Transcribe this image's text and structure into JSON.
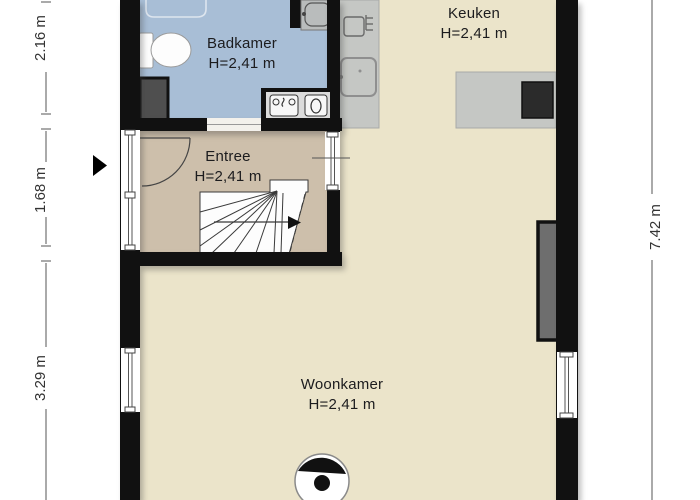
{
  "rooms": {
    "badkamer": {
      "name": "Badkamer",
      "height": "H=2,41 m"
    },
    "keuken": {
      "name": "Keuken",
      "height": "H=2,41 m"
    },
    "entree": {
      "name": "Entree",
      "height": "H=2,41 m"
    },
    "woonkamer": {
      "name": "Woonkamer",
      "height": "H=2,41 m"
    }
  },
  "dimensions": {
    "left": [
      {
        "label": "2.16 m"
      },
      {
        "label": "1.68 m"
      },
      {
        "label": "3.29 m"
      }
    ],
    "right": [
      {
        "label": "7.42 m"
      }
    ]
  },
  "icons": {
    "entrance": "entrance-arrow-icon",
    "stairs": "stairs-icon",
    "door": "door-swing-icon",
    "toilet": "toilet-icon",
    "shower": "shower-icon",
    "corner_washbasin": "washbasin-icon",
    "vanity": "double-washbasin-icon",
    "kitchen_sink": "kitchen-sink-icon",
    "cooktop": "cooktop-icon",
    "oven": "dark-appliance-icon",
    "stove": "wood-stove-icon",
    "radiator": "radiator-icon",
    "window": "window-icon"
  },
  "colors": {
    "outside": "#ffffff",
    "wall": "#111111",
    "bathroom_floor": "#a8bed6",
    "entree_floor": "#cdbfab",
    "living_floor": "#ebe4ca",
    "counter": "#c5c7c4",
    "counter_border": "#a8aaa8",
    "appliance_dark": "#2b2b2b",
    "radiator": "#6e6e6e",
    "shaft": "#4f4f4f",
    "vanity_top": "#dcdcdc",
    "fixture_stroke": "#8f8f8f",
    "dimension_text": "#333333",
    "dimension_line": "#555555",
    "room_text": "#1c1c1e"
  }
}
